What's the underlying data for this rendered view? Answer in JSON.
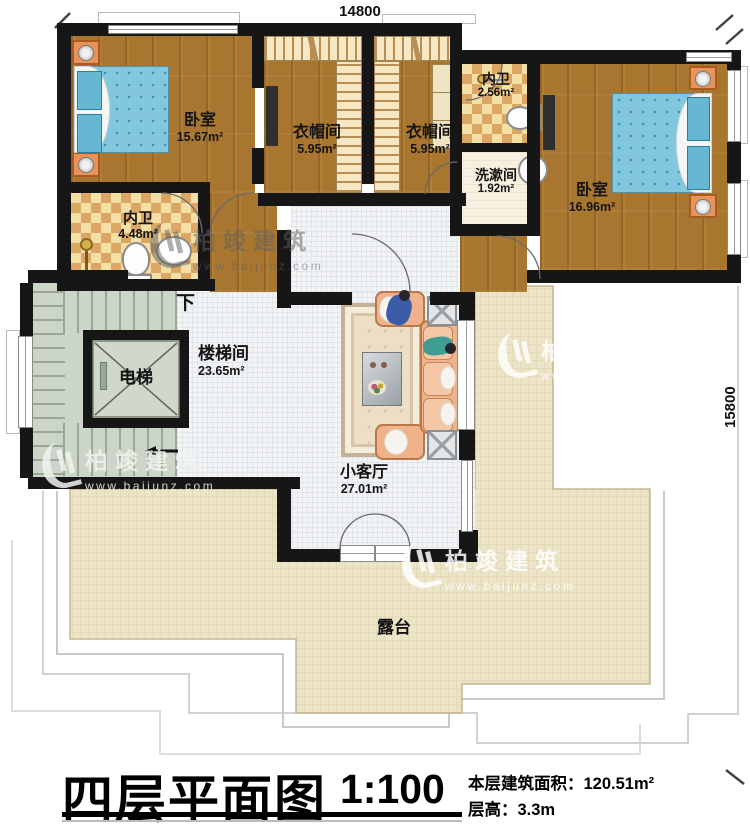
{
  "dimensions": {
    "top": "14800",
    "right": "15800"
  },
  "rooms": {
    "bedroom_left": {
      "name": "卧室",
      "area": "15.67m²"
    },
    "closet_left": {
      "name": "衣帽间",
      "area": "5.95m²"
    },
    "closet_right": {
      "name": "衣帽间",
      "area": "5.95m²"
    },
    "bath_top": {
      "name": "内卫",
      "area": "2.56m²"
    },
    "washroom": {
      "name": "洗漱间",
      "area": "1.92m²"
    },
    "bedroom_right": {
      "name": "卧室",
      "area": "16.96m²"
    },
    "bath_left": {
      "name": "内卫",
      "area": "4.48m²"
    },
    "stairwell": {
      "name": "楼梯间",
      "area": "23.65m²"
    },
    "elevator": {
      "name": "电梯"
    },
    "living": {
      "name": "小客厅",
      "area": "27.01m²"
    },
    "terrace": {
      "name": "露台"
    }
  },
  "stairs": {
    "direction_label": "下"
  },
  "title": {
    "name": "四层平面图",
    "scale": "1:100",
    "area_label": "本层建筑面积：",
    "area_value": "120.51m²",
    "floor_height_label": "层高：",
    "floor_height_value": "3.3m"
  },
  "watermark": {
    "brand": "柏竣建筑",
    "url": "www.baijunz.com"
  },
  "colors": {
    "wall": "#161616",
    "wood": "#a9762f",
    "terrace": "#ece4c6",
    "stairs": "#ccd6c8",
    "bed": "#82c7de",
    "sofa": "#f0b28b"
  }
}
